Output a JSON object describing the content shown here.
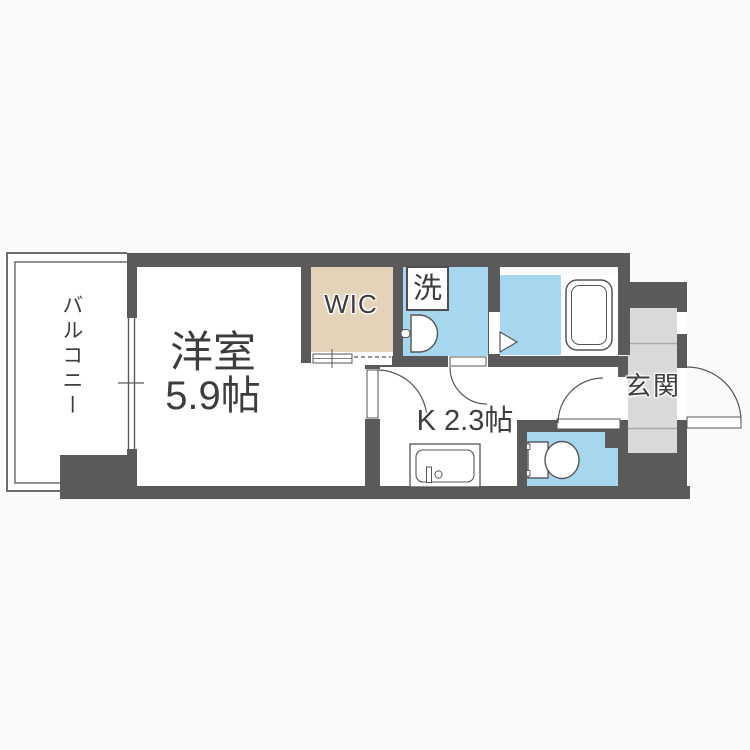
{
  "plan": {
    "labels": {
      "balcony": "バルコニー",
      "room_name": "洋室",
      "room_size": "5.9帖",
      "wic": "WIC",
      "laundry": "洗",
      "kitchen": "K 2.3帖",
      "entrance": "玄関"
    },
    "colors": {
      "wall": "#5a5a5a",
      "water_area_floor": "#a6d7ef",
      "closet_floor": "#e4d3b8",
      "entrance_floor": "#d9d9d9",
      "room_floor": "#ffffff",
      "background": "#fafafa",
      "fixture_outline": "#555555"
    },
    "icons": {
      "bathtub-icon": "double rounded rectangle",
      "toilet-icon": "tank with bowl",
      "wash-basin-icon": "half-round basin with faucet",
      "kitchen-sink-icon": "counter with rounded sink and faucet",
      "washing-machine-area-icon": "outlined box",
      "door-swing-icon": "quarter arc with leaf",
      "folding-door-icon": "white triangle",
      "window-icon": "parallel lines in wall gap"
    }
  }
}
